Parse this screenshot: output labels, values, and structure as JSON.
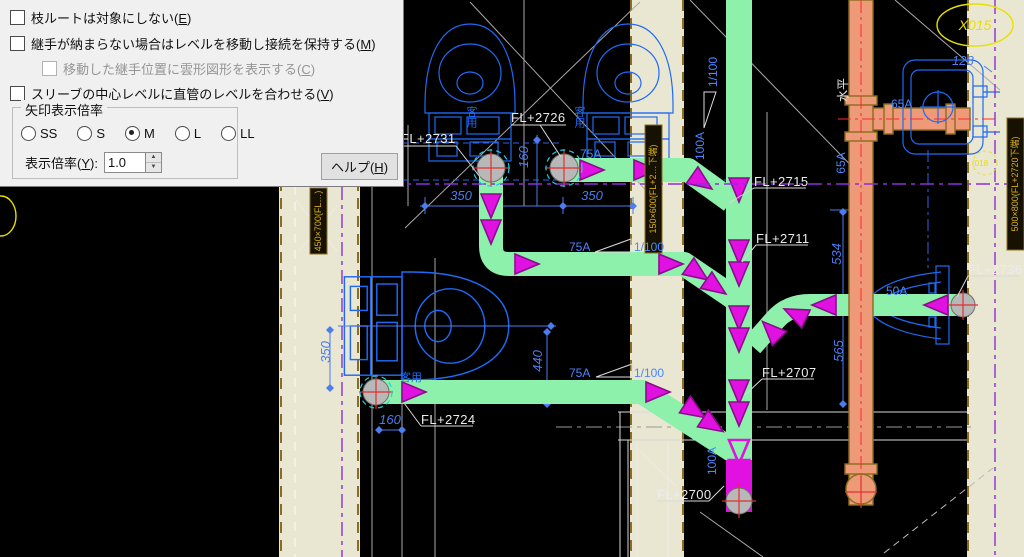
{
  "dialog": {
    "checkboxes": [
      {
        "pre": "枝ルートは対象にしない(",
        "mn": "E",
        "post": ")"
      },
      {
        "pre": "継手が納まらない場合はレベルを移動し接続を保持する(",
        "mn": "M",
        "post": ")"
      },
      {
        "pre": "移動した継手位置に雲形図形を表示する(",
        "mn": "C",
        "post": ")"
      },
      {
        "pre": "スリーブの中心レベルに直管のレベルを合わせる(",
        "mn": "V",
        "post": ")"
      }
    ],
    "arrow_group": {
      "title": "矢印表示倍率",
      "radios": [
        {
          "label": "SS"
        },
        {
          "label": "S"
        },
        {
          "label": "M"
        },
        {
          "label": "L"
        },
        {
          "label": "LL"
        }
      ],
      "selected": "M",
      "scale_pre": "表示倍率(",
      "scale_mn": "Y",
      "scale_post": "):",
      "scale_value": "1.0"
    },
    "help_pre": "ヘルプ(",
    "help_mn": "H",
    "help_post": ")"
  },
  "drawing": {
    "fl_labels": [
      "FL+2731",
      "FL+2726",
      "FL+2715",
      "FL+2711",
      "FL+2707",
      "FL+2700",
      "FL+2736",
      "FL+2724"
    ],
    "pipe_sizes": {
      "p75": "75A",
      "p50": "50A",
      "p65": "65A",
      "p100": "100A"
    },
    "slope": "1/100",
    "level_note": "水平",
    "dims": {
      "d350": "350",
      "d160": "160",
      "d440": "440",
      "d534": "534",
      "d565": "565",
      "d128": "128"
    },
    "room_label": "客用",
    "balloon": "X015",
    "small_tag": "(018",
    "sleeve_tags": [
      "450×700(FL…)",
      "150×600(FL+2…下端)",
      "500×800(FL+2720下端)"
    ],
    "colors": {
      "pipe_green": "#8df0ab",
      "arrow_magenta": "#e112e1",
      "pipe_orange": "#ee9a79",
      "fixture_blue": "#1f6af5",
      "dim_blue": "#4b7df0",
      "wall_beige": "#e9e6d2",
      "centerline_purple": "#8b2fd6",
      "annotation_yellow": "#e8e000"
    }
  }
}
